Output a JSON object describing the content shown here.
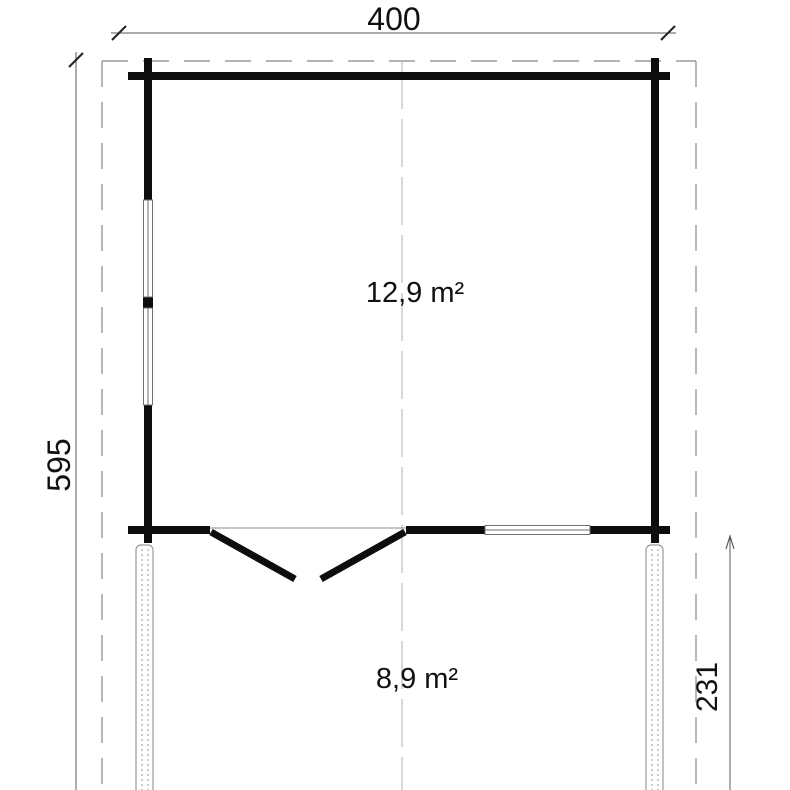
{
  "drawing": {
    "type": "floor-plan",
    "dimensions": {
      "overall_width": {
        "label": "400"
      },
      "overall_depth": {
        "label": "595"
      },
      "terrace_depth": {
        "label": "231"
      }
    },
    "areas": {
      "main_room": {
        "label": "12,9 m²"
      },
      "terrace": {
        "label": "8,9 m²"
      }
    },
    "colors": {
      "wall": "#0d0d0d",
      "dimension_text": "#111111",
      "dimension_line": "#5a5a5a",
      "dashed_roof_outline": "#9a9a9a",
      "center_axis": "#bdbdbd",
      "window_outline": "#6f6f6f",
      "post_outline": "#9a9a9a",
      "background": "#ffffff"
    }
  }
}
